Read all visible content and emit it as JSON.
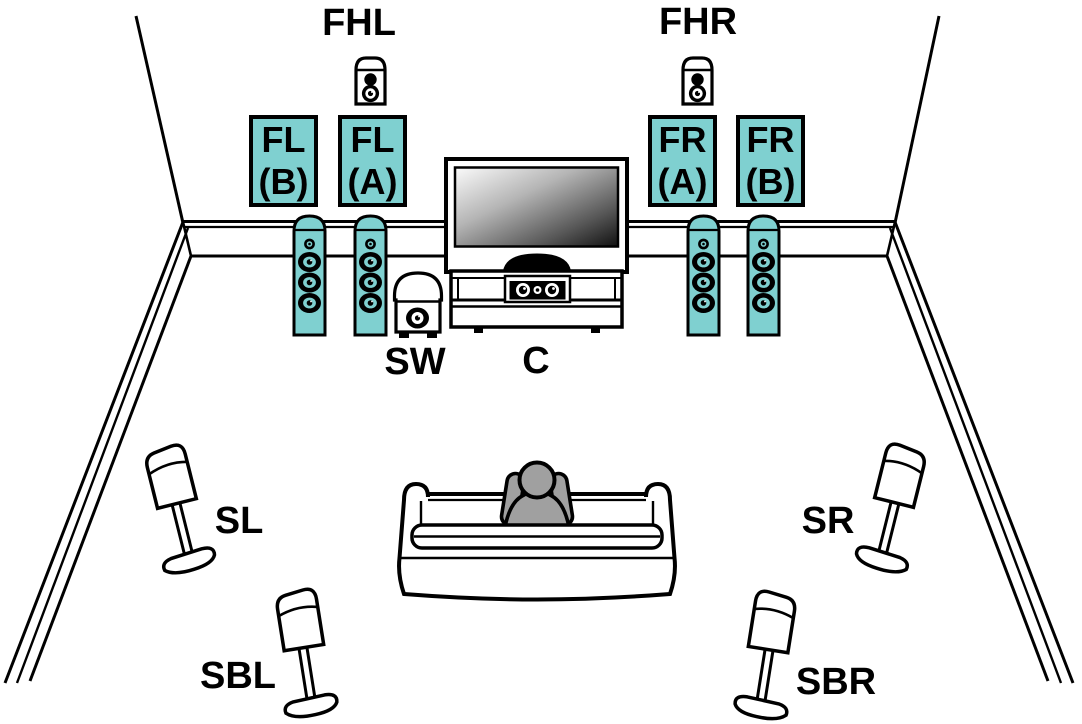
{
  "colors": {
    "accent": "#7FD0D0",
    "line": "#000000",
    "person": "#A0A0A0",
    "background": "#FFFFFF"
  },
  "labels": {
    "front_height_left": "FHL",
    "front_height_right": "FHR",
    "subwoofer": "SW",
    "center": "C",
    "surround_left": "SL",
    "surround_right": "SR",
    "surround_back_left": "SBL",
    "surround_back_right": "SBR"
  },
  "speaker_boxes": [
    {
      "id": "front-left-b",
      "line1": "FL",
      "line2": "(B)"
    },
    {
      "id": "front-left-a",
      "line1": "FL",
      "line2": "(A)"
    },
    {
      "id": "front-right-a",
      "line1": "FR",
      "line2": "(A)"
    },
    {
      "id": "front-right-b",
      "line1": "FR",
      "line2": "(B)"
    }
  ],
  "icons": [
    "room-outline-icon",
    "front-height-left-speaker-icon",
    "front-height-right-speaker-icon",
    "front-left-tower-b-icon",
    "front-left-tower-a-icon",
    "front-right-tower-a-icon",
    "front-right-tower-b-icon",
    "subwoofer-icon",
    "tv-icon",
    "tv-stand-icon",
    "center-speaker-icon",
    "sofa-icon",
    "listener-icon",
    "surround-left-speaker-icon",
    "surround-right-speaker-icon",
    "surround-back-left-speaker-icon",
    "surround-back-right-speaker-icon"
  ]
}
